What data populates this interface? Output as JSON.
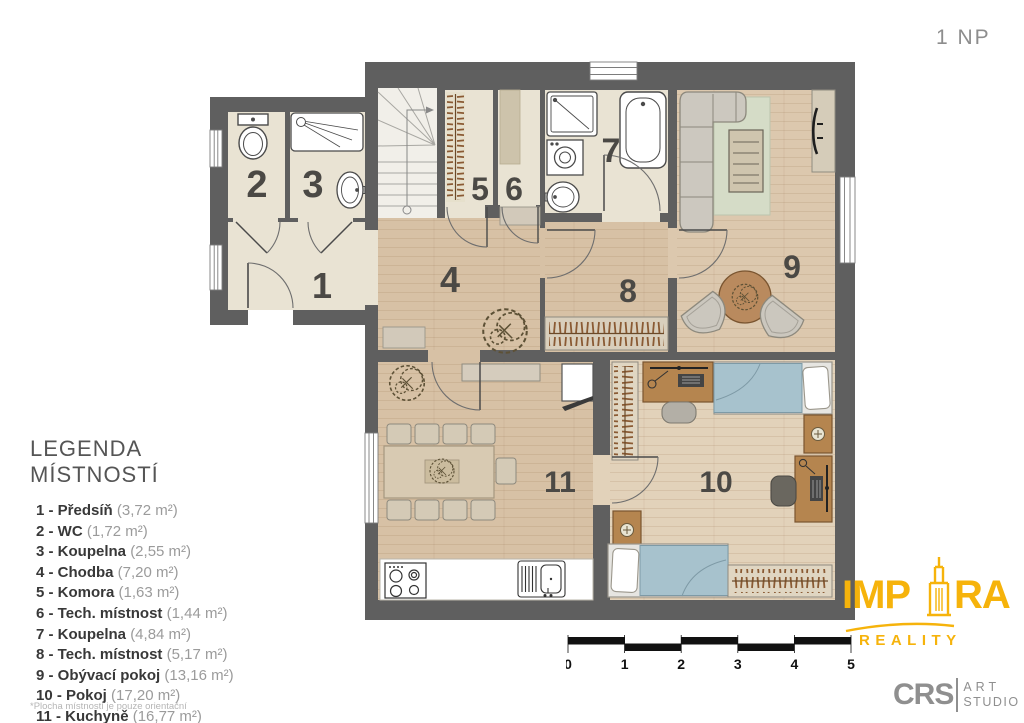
{
  "floor_label": "1 NP",
  "legend": {
    "title": "LEGENDA MÍSTNOSTÍ",
    "items": [
      {
        "label": "1 - Předsíň",
        "area": "(3,72 m²)"
      },
      {
        "label": "2 - WC",
        "area": "(1,72 m²)"
      },
      {
        "label": "3 - Koupelna",
        "area": "(2,55 m²)"
      },
      {
        "label": "4 - Chodba",
        "area": "(7,20 m²)"
      },
      {
        "label": "5 - Komora",
        "area": "(1,63 m²)"
      },
      {
        "label": "6 - Tech. místnost",
        "area": "(1,44 m²)"
      },
      {
        "label": "7 - Koupelna",
        "area": "(4,84 m²)"
      },
      {
        "label": "8 - Tech. místnost",
        "area": "(5,17 m²)"
      },
      {
        "label": "9 - Obývací pokoj",
        "area": "(13,16 m²)"
      },
      {
        "label": "10 - Pokoj",
        "area": "(17,20 m²)"
      },
      {
        "label": "11 - Kuchyně",
        "area": "(16,77 m²)"
      }
    ],
    "footnote": "*Plocha místností je pouze orientační"
  },
  "plan": {
    "room_labels": {
      "r1": "1",
      "r2": "2",
      "r3": "3",
      "r4": "4",
      "r5": "5",
      "r6": "6",
      "r7": "7",
      "r8": "8",
      "r9": "9",
      "r10": "10",
      "r11": "11"
    }
  },
  "scalebar": {
    "labels": [
      "0",
      "1",
      "2",
      "3",
      "4",
      "5"
    ]
  },
  "logos": {
    "impira": {
      "text_left": "IMP",
      "text_right": "RA",
      "subtitle": "REALITY"
    },
    "crs": {
      "initials": "CRS",
      "line1": "ART",
      "line2": "STUDIO"
    }
  },
  "colors": {
    "accent_yellow": "#F6B30B",
    "wall_gray": "#5f5f5f",
    "wood_floor": "#d7c1a5",
    "tile_floor": "#e9e3d3",
    "rug_green": "#d5dcc7",
    "blanket_blue": "#a7c2cd",
    "logo_gray": "#8f8f8f"
  }
}
